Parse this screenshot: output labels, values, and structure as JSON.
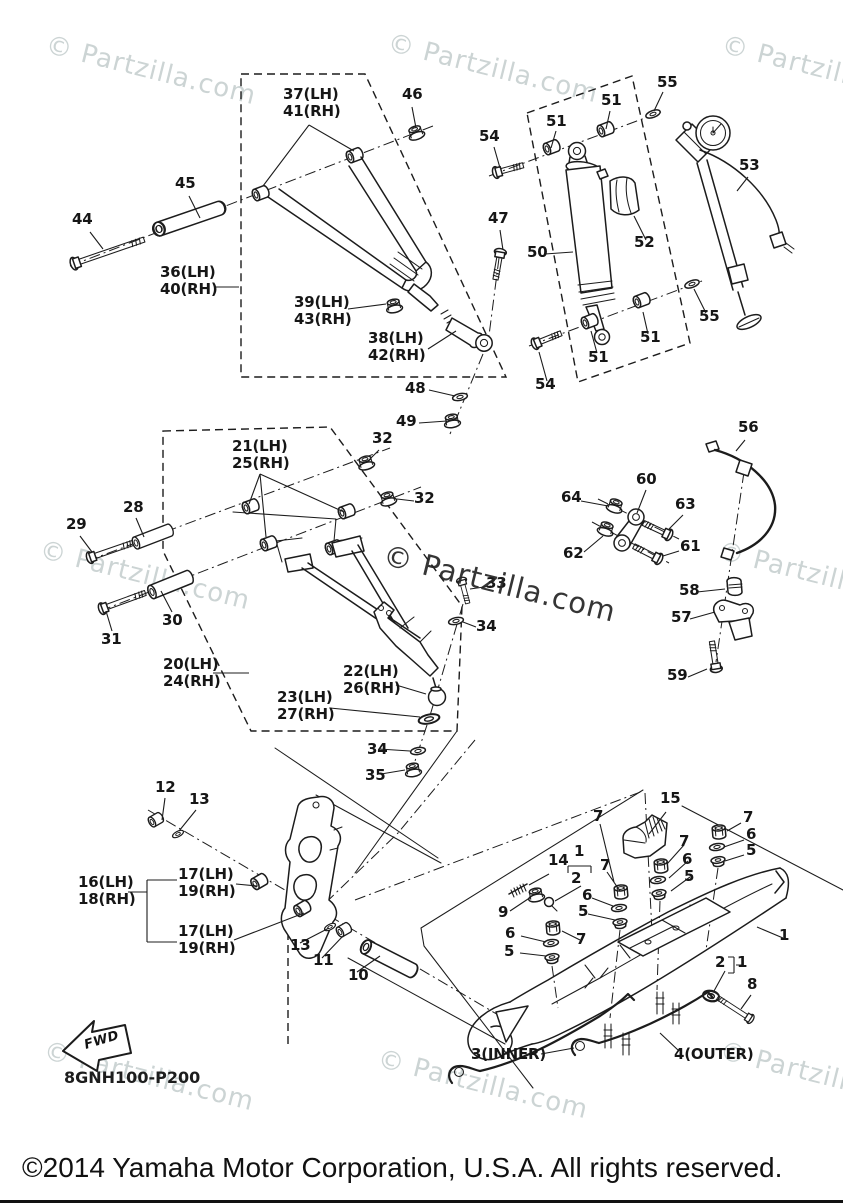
{
  "watermark": {
    "text": "© Partzilla.com",
    "light_color": "#ccd4d4",
    "dark_color": "#262626",
    "instances": [
      {
        "x": 50,
        "y": 30,
        "tone": "light"
      },
      {
        "x": 392,
        "y": 28,
        "tone": "light"
      },
      {
        "x": 726,
        "y": 30,
        "tone": "light"
      },
      {
        "x": 44,
        "y": 535,
        "tone": "light"
      },
      {
        "x": 388,
        "y": 538,
        "tone": "dark"
      },
      {
        "x": 722,
        "y": 536,
        "tone": "light"
      },
      {
        "x": 48,
        "y": 1036,
        "tone": "light"
      },
      {
        "x": 382,
        "y": 1044,
        "tone": "light"
      },
      {
        "x": 724,
        "y": 1036,
        "tone": "light"
      }
    ]
  },
  "diagram": {
    "part_code": "8GNH100-P200",
    "fwd_label": "FWD"
  },
  "footer": {
    "copyright": "©2014 Yamaha Motor Corporation, U.S.A. All rights reserved."
  },
  "callouts": [
    {
      "t": [
        "37(LH)",
        "41(RH)"
      ],
      "x": 283,
      "y": 86
    },
    {
      "t": [
        "46"
      ],
      "x": 402,
      "y": 86
    },
    {
      "t": [
        "45"
      ],
      "x": 175,
      "y": 175
    },
    {
      "t": [
        "44"
      ],
      "x": 72,
      "y": 211
    },
    {
      "t": [
        "36(LH)",
        "40(RH)"
      ],
      "x": 160,
      "y": 264
    },
    {
      "t": [
        "39(LH)",
        "43(RH)"
      ],
      "x": 294,
      "y": 294
    },
    {
      "t": [
        "38(LH)",
        "42(RH)"
      ],
      "x": 368,
      "y": 330
    },
    {
      "t": [
        "48"
      ],
      "x": 405,
      "y": 380
    },
    {
      "t": [
        "49"
      ],
      "x": 396,
      "y": 413
    },
    {
      "t": [
        "54"
      ],
      "x": 479,
      "y": 128
    },
    {
      "t": [
        "51"
      ],
      "x": 546,
      "y": 113
    },
    {
      "t": [
        "51"
      ],
      "x": 601,
      "y": 92
    },
    {
      "t": [
        "55"
      ],
      "x": 657,
      "y": 74
    },
    {
      "t": [
        "53"
      ],
      "x": 739,
      "y": 157
    },
    {
      "t": [
        "50"
      ],
      "x": 527,
      "y": 244
    },
    {
      "t": [
        "52"
      ],
      "x": 634,
      "y": 234
    },
    {
      "t": [
        "47"
      ],
      "x": 488,
      "y": 210
    },
    {
      "t": [
        "54"
      ],
      "x": 535,
      "y": 376
    },
    {
      "t": [
        "55"
      ],
      "x": 699,
      "y": 308
    },
    {
      "t": [
        "51"
      ],
      "x": 640,
      "y": 329
    },
    {
      "t": [
        "51"
      ],
      "x": 588,
      "y": 349
    },
    {
      "t": [
        "32"
      ],
      "x": 372,
      "y": 430
    },
    {
      "t": [
        "21(LH)",
        "25(RH)"
      ],
      "x": 232,
      "y": 438
    },
    {
      "t": [
        "32"
      ],
      "x": 414,
      "y": 490
    },
    {
      "t": [
        "28"
      ],
      "x": 123,
      "y": 499
    },
    {
      "t": [
        "29"
      ],
      "x": 66,
      "y": 516
    },
    {
      "t": [
        "30"
      ],
      "x": 162,
      "y": 612
    },
    {
      "t": [
        "31"
      ],
      "x": 101,
      "y": 631
    },
    {
      "t": [
        "20(LH)",
        "24(RH)"
      ],
      "x": 163,
      "y": 656
    },
    {
      "t": [
        "22(LH)",
        "26(RH)"
      ],
      "x": 343,
      "y": 663
    },
    {
      "t": [
        "23(LH)",
        "27(RH)"
      ],
      "x": 277,
      "y": 689
    },
    {
      "t": [
        "33"
      ],
      "x": 486,
      "y": 575
    },
    {
      "t": [
        "34"
      ],
      "x": 476,
      "y": 618
    },
    {
      "t": [
        "34"
      ],
      "x": 367,
      "y": 741
    },
    {
      "t": [
        "35"
      ],
      "x": 365,
      "y": 767
    },
    {
      "t": [
        "56"
      ],
      "x": 738,
      "y": 419
    },
    {
      "t": [
        "60"
      ],
      "x": 636,
      "y": 471
    },
    {
      "t": [
        "64"
      ],
      "x": 561,
      "y": 489
    },
    {
      "t": [
        "63"
      ],
      "x": 675,
      "y": 496
    },
    {
      "t": [
        "62"
      ],
      "x": 563,
      "y": 545
    },
    {
      "t": [
        "61"
      ],
      "x": 680,
      "y": 538
    },
    {
      "t": [
        "58"
      ],
      "x": 679,
      "y": 582
    },
    {
      "t": [
        "57"
      ],
      "x": 671,
      "y": 609
    },
    {
      "t": [
        "59"
      ],
      "x": 667,
      "y": 667
    },
    {
      "t": [
        "12"
      ],
      "x": 155,
      "y": 779
    },
    {
      "t": [
        "13"
      ],
      "x": 189,
      "y": 791
    },
    {
      "t": [
        "16(LH)",
        "18(RH)"
      ],
      "x": 78,
      "y": 874
    },
    {
      "t": [
        "17(LH)",
        "19(RH)"
      ],
      "x": 178,
      "y": 866
    },
    {
      "t": [
        "17(LH)",
        "19(RH)"
      ],
      "x": 178,
      "y": 923
    },
    {
      "t": [
        "13"
      ],
      "x": 290,
      "y": 937
    },
    {
      "t": [
        "11"
      ],
      "x": 313,
      "y": 952
    },
    {
      "t": [
        "10"
      ],
      "x": 348,
      "y": 967
    },
    {
      "t": [
        "15"
      ],
      "x": 660,
      "y": 790
    },
    {
      "t": [
        "7"
      ],
      "x": 743,
      "y": 809
    },
    {
      "t": [
        "6"
      ],
      "x": 746,
      "y": 826
    },
    {
      "t": [
        "5"
      ],
      "x": 746,
      "y": 842
    },
    {
      "t": [
        "7"
      ],
      "x": 679,
      "y": 833
    },
    {
      "t": [
        "6"
      ],
      "x": 682,
      "y": 851
    },
    {
      "t": [
        "5"
      ],
      "x": 684,
      "y": 868
    },
    {
      "t": [
        "14"
      ],
      "x": 548,
      "y": 852
    },
    {
      "t": [
        "1"
      ],
      "x": 574,
      "y": 843
    },
    {
      "t": [
        "2"
      ],
      "x": 571,
      "y": 870
    },
    {
      "t": [
        "7"
      ],
      "x": 593,
      "y": 808
    },
    {
      "t": [
        "7"
      ],
      "x": 600,
      "y": 857
    },
    {
      "t": [
        "6"
      ],
      "x": 582,
      "y": 887
    },
    {
      "t": [
        "5"
      ],
      "x": 578,
      "y": 903
    },
    {
      "t": [
        "9"
      ],
      "x": 498,
      "y": 904
    },
    {
      "t": [
        "6"
      ],
      "x": 505,
      "y": 925
    },
    {
      "t": [
        "7"
      ],
      "x": 576,
      "y": 931
    },
    {
      "t": [
        "5"
      ],
      "x": 504,
      "y": 943
    },
    {
      "t": [
        "1"
      ],
      "x": 779,
      "y": 927
    },
    {
      "t": [
        "2"
      ],
      "x": 715,
      "y": 954
    },
    {
      "t": [
        "1"
      ],
      "x": 737,
      "y": 954
    },
    {
      "t": [
        "8"
      ],
      "x": 747,
      "y": 976
    },
    {
      "t": [
        "3(INNER)"
      ],
      "x": 471,
      "y": 1046
    },
    {
      "t": [
        "4(OUTER)"
      ],
      "x": 674,
      "y": 1046
    }
  ]
}
